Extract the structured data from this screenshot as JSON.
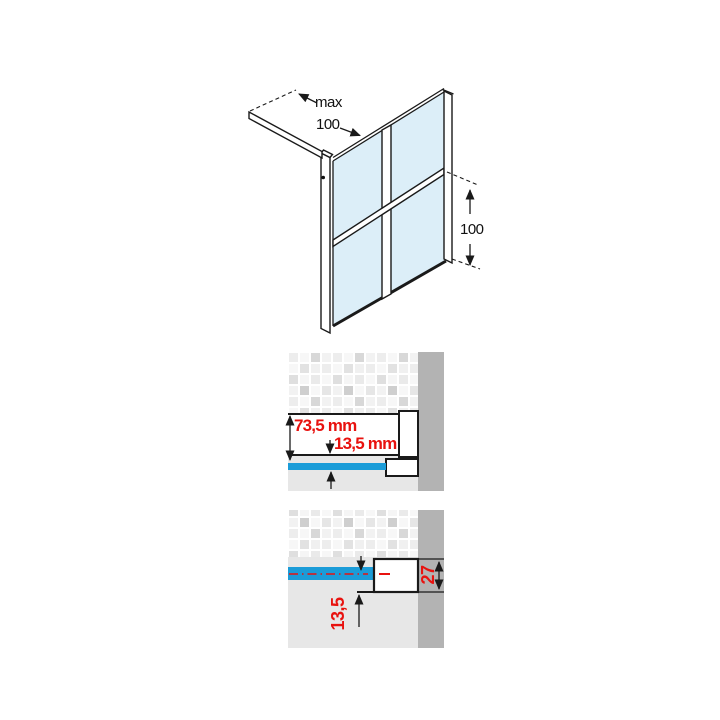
{
  "colors": {
    "glass": "#dceef8",
    "blue": "#1b9cd8",
    "red": "#e8120f",
    "wall": "#b3b3b3",
    "floor": "#e7e7e7",
    "outline": "#1a1a1a",
    "profile_white": "#ffffff"
  },
  "iso_view": {
    "max_label": "max",
    "max_value": "100",
    "height_value": "100"
  },
  "wall_section_top": {
    "total_depth_label": "73,5 mm",
    "offset_label": "13,5 mm"
  },
  "wall_section_bottom": {
    "profile_height_label": "27",
    "offset_label": "13,5"
  }
}
